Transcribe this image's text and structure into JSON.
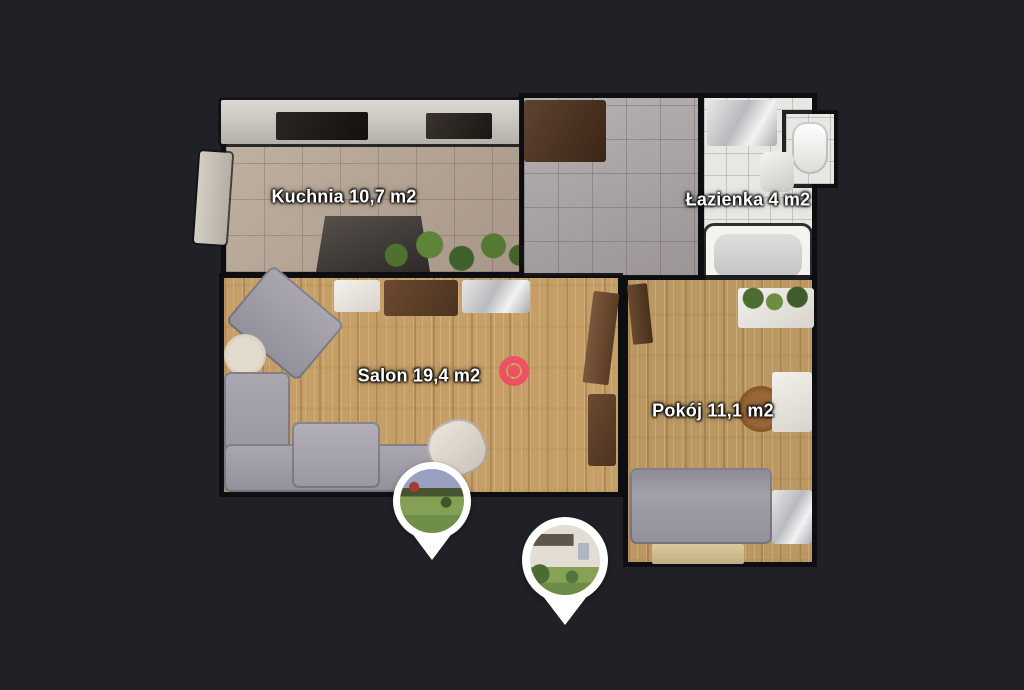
{
  "app": {
    "background_color": "#1f2126",
    "accent_color": "#ef5062",
    "pin_color": "#ffffff"
  },
  "floorplan": {
    "rooms": [
      {
        "id": "kuchnia",
        "name": "Kuchnia",
        "area": "10,7 m2",
        "label": "Kuchnia 10,7 m2"
      },
      {
        "id": "lazienka",
        "name": "Łazienka",
        "area": "4 m2",
        "label": "Łazienka 4 m2"
      },
      {
        "id": "salon",
        "name": "Salon",
        "area": "19,4 m2",
        "label": "Salon 19,4 m2"
      },
      {
        "id": "pokoj",
        "name": "Pokój",
        "area": "11,1 m2",
        "label": "Pokój 11,1 m2"
      }
    ],
    "markers": [
      {
        "id": "view-point",
        "icon": "360-view-point-icon",
        "color": "#ef5062",
        "room": "salon"
      },
      {
        "id": "photo-pin-1",
        "icon": "photo-pin-icon",
        "photo": "garden lawn with building"
      },
      {
        "id": "photo-pin-2",
        "icon": "photo-pin-icon",
        "photo": "house facade with garden"
      }
    ]
  }
}
